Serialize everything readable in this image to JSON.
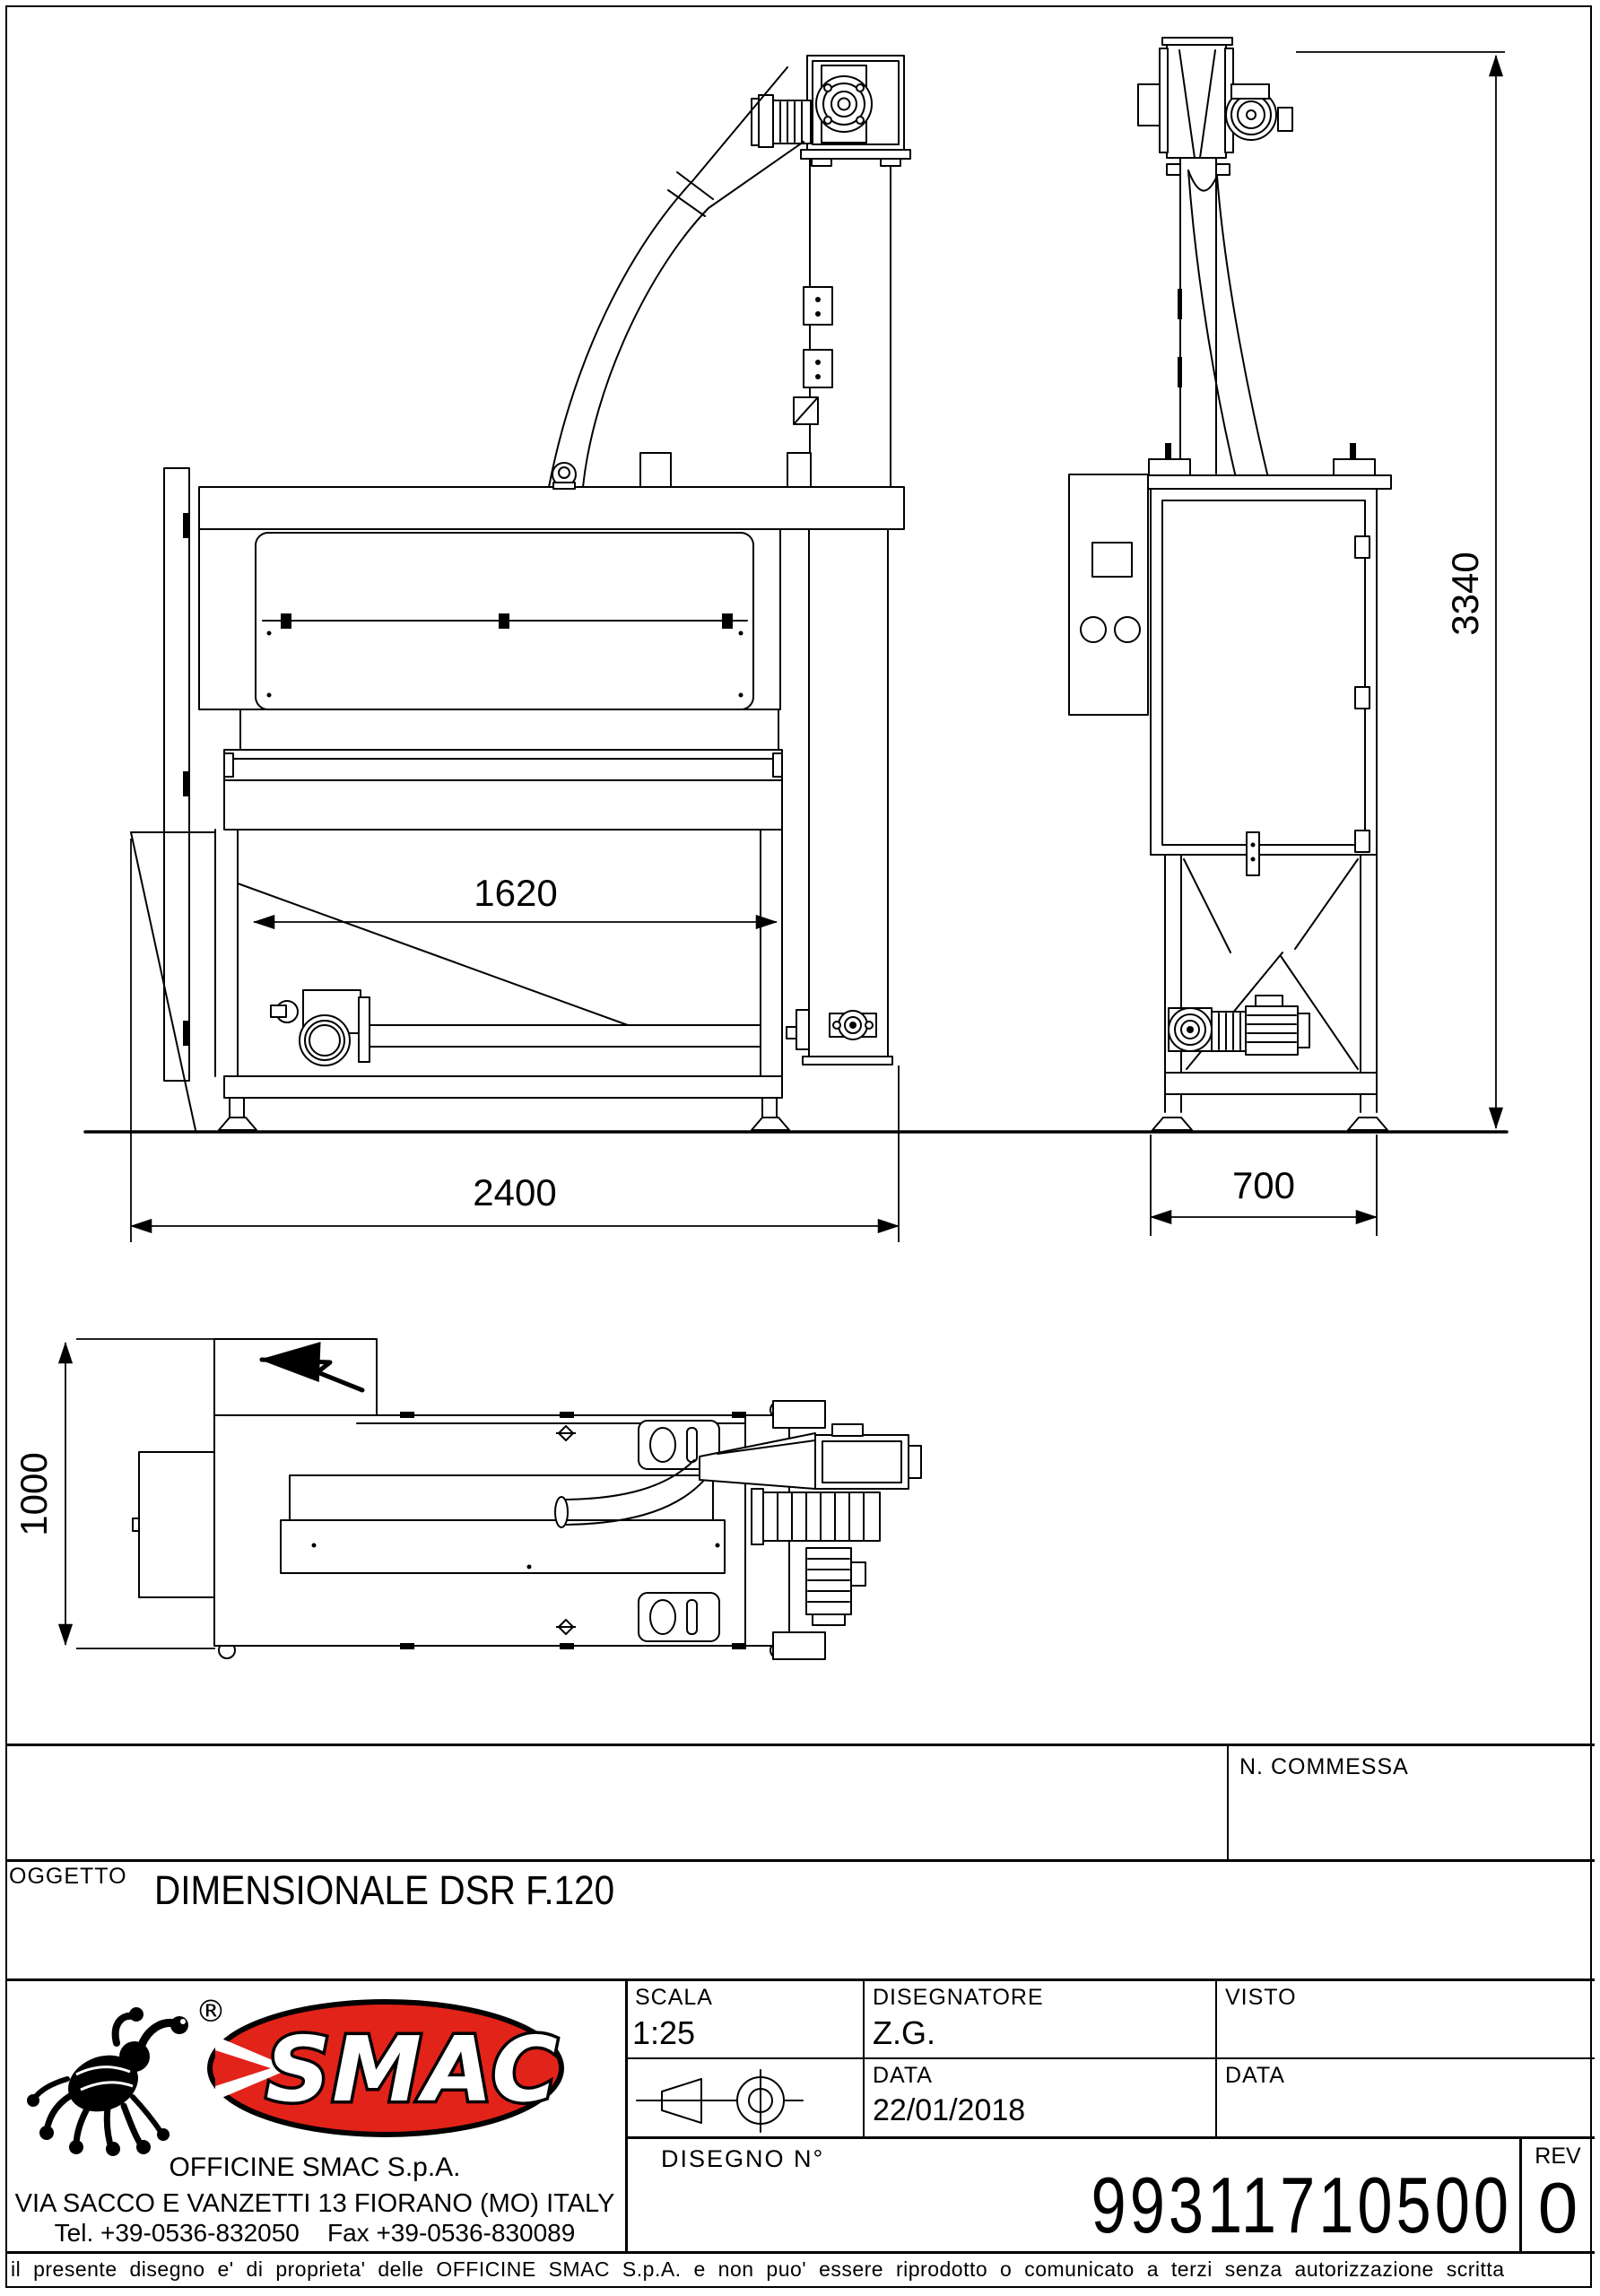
{
  "drawing": {
    "dimensions": {
      "hopper_width": "1620",
      "overall_width": "2400",
      "depth": "700",
      "overall_height": "3340",
      "plan_depth": "1000"
    }
  },
  "title_block": {
    "commessa_label": "N.  COMMESSA",
    "oggetto_label": "OGGETTO",
    "oggetto_value": "DIMENSIONALE DSR F.120",
    "scala_label": "SCALA",
    "scala_value": "1:25",
    "disegnatore_label": "DISEGNATORE",
    "disegnatore_value": "Z.G.",
    "visto_label": "VISTO",
    "data_label": "DATA",
    "data_value": "22/01/2018",
    "data2_label": "DATA",
    "data2_value": "",
    "disegno_label": "DISEGNO  N°",
    "disegno_value": "99311710500",
    "rev_label": "REV",
    "rev_value": "0"
  },
  "company": {
    "logo_text": "SMAC",
    "registered_mark": "®",
    "name": "OFFICINE SMAC S.p.A.",
    "address": "VIA SACCO E VANZETTI 13 FIORANO (MO) ITALY",
    "phone": "Tel. +39-0536-832050    Fax +39-0536-830089"
  },
  "footer": {
    "disclaimer": "il  presente  disegno  e'  di  proprieta'  delle  OFFICINE  SMAC  S.p.A.  e  non  puo'  essere  riprodotto  o  comunicato  a  terzi  senza  autorizzazione  scritta"
  },
  "colors": {
    "logo_red": "#e2231a",
    "line_black": "#000000"
  }
}
